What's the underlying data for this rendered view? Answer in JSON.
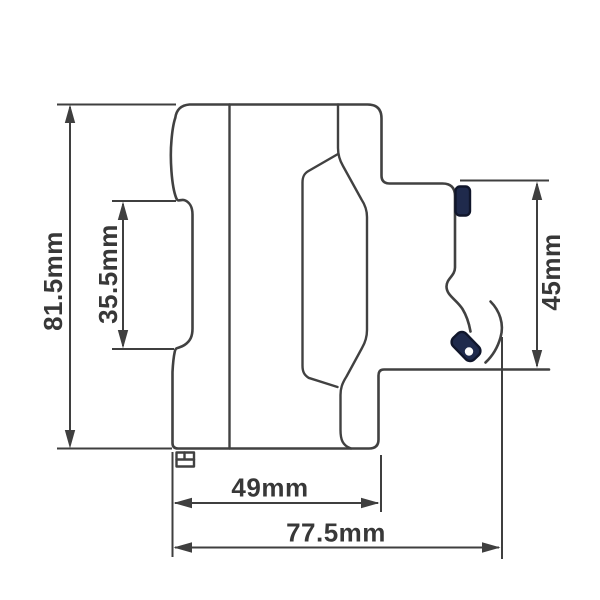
{
  "drawing": {
    "units": "mm",
    "colors": {
      "line": "#414141",
      "label": "#383838",
      "accent_navy": "#1f2a4c",
      "background": "#ffffff"
    },
    "dimensions": [
      {
        "name": "overall-height",
        "label": "81.5mm",
        "value": 81.5,
        "orientation": "vertical"
      },
      {
        "name": "din-rail-recess-height",
        "label": "35.5mm",
        "value": 35.5,
        "orientation": "vertical"
      },
      {
        "name": "front-section-height",
        "label": "45mm",
        "value": 45,
        "orientation": "vertical"
      },
      {
        "name": "body-depth",
        "label": "49mm",
        "value": 49,
        "orientation": "horizontal"
      },
      {
        "name": "overall-depth",
        "label": "77.5mm",
        "value": 77.5,
        "orientation": "horizontal"
      }
    ]
  }
}
